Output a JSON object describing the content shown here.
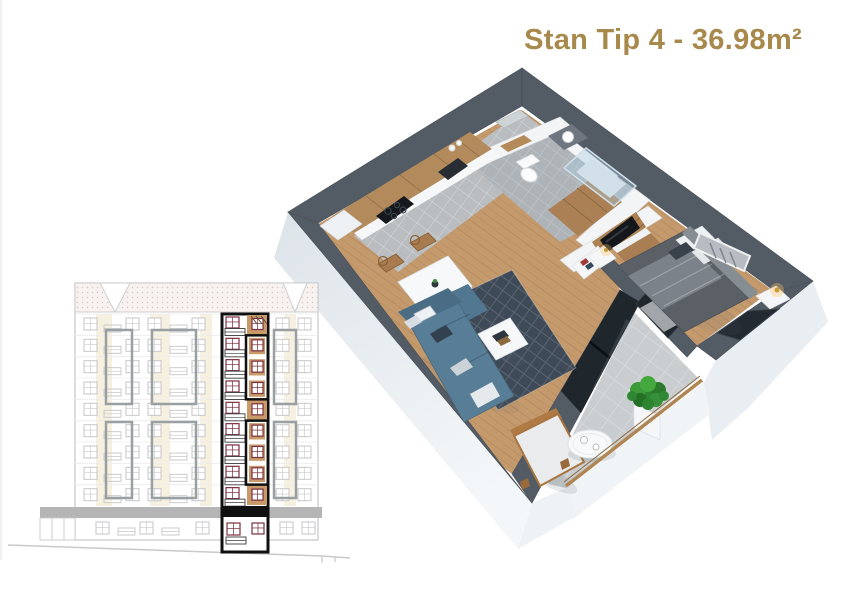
{
  "theme": {
    "title-color": "#a8894c",
    "page-bg": "#ffffff"
  },
  "title": {
    "text": "Stan Tip 4 - 36.98m²"
  },
  "floor_plan_3d": {
    "description": "3D cutaway render of apartment type 4",
    "area": "36.98m²",
    "rooms": [
      "kitchen",
      "dining area",
      "living room",
      "hallway",
      "bathroom",
      "wc",
      "bedroom",
      "balcony"
    ],
    "furniture": [
      "kitchen cabinets",
      "cooktop",
      "sink",
      "dining table",
      "four wood chairs",
      "corner sofa",
      "patterned rug",
      "coffee table",
      "tv wall unit",
      "media console",
      "wardrobe",
      "double bed",
      "nightstands",
      "bedside lamps",
      "wall art",
      "toilet",
      "shower",
      "vanity sink",
      "balcony bench",
      "round balcony table",
      "potted plant",
      "glass railing"
    ],
    "colors": {
      "wall_top": "#535b64",
      "wall_face": "#e7edf1",
      "wood_floor": "#c49a6d",
      "tile_floor": "#b9bdc0",
      "bath_tile": "#aeb3b8",
      "balcony_tile": "#c9cdcf",
      "cabinet_wood": "#b28a5b",
      "sofa": "#587e97",
      "rug": "#3e4a57",
      "plant": "#2e8530",
      "glazing": "#20262c",
      "handrail_wood": "#b08554"
    }
  },
  "elevation": {
    "description": "building facade elevation with highlighted apartment column",
    "colors": {
      "line": "#c6c6c8",
      "frame": "#9aa0a2",
      "beige": "#f4eddc",
      "tan": "#c89a69",
      "maroon": "#7b2f3f",
      "highlight": "#101010",
      "canopy": "#b5b5b5",
      "slabline": "#ececec"
    },
    "building": {
      "x": 75,
      "y": 283,
      "w": 243,
      "h": 257
    },
    "roof_h": 29,
    "floor_rows_y": [
      314,
      335.3,
      356.7,
      378,
      399.3,
      420.7,
      442,
      463.3,
      484.7
    ],
    "windows_x": [
      84,
      126,
      148,
      192,
      276,
      298
    ],
    "rails_x": [
      104,
      170
    ],
    "ground_row_y": 517,
    "ground_windows_x": [
      96,
      140,
      196,
      280,
      302
    ],
    "ground_rails_x": [
      118,
      162
    ],
    "beige_strips": [
      {
        "x": 96,
        "w": 16
      },
      {
        "x": 150,
        "w": 20
      },
      {
        "x": 200,
        "w": 12
      },
      {
        "x": 284,
        "w": 12
      }
    ],
    "strip_y": 314,
    "strip_h": 192,
    "gray_boxes": [
      {
        "x": 106,
        "y": 330,
        "w": 26,
        "h": 74
      },
      {
        "x": 152,
        "y": 330,
        "w": 44,
        "h": 74
      },
      {
        "x": 274,
        "y": 330,
        "w": 22,
        "h": 74
      },
      {
        "x": 106,
        "y": 422,
        "w": 26,
        "h": 76
      },
      {
        "x": 152,
        "y": 422,
        "w": 44,
        "h": 76
      },
      {
        "x": 274,
        "y": 422,
        "w": 22,
        "h": 76
      }
    ],
    "highlight": {
      "x": 222,
      "y": 314,
      "w": 46,
      "h": 238,
      "split": 25,
      "floors": 9,
      "cell_h": 21.33,
      "tan_rows": [
        0,
        4,
        8
      ],
      "subboxes": [
        [
          1,
          3
        ],
        [
          5,
          7
        ]
      ],
      "slab_y": 506,
      "slab_h": 11,
      "ground_y": 517
    }
  }
}
